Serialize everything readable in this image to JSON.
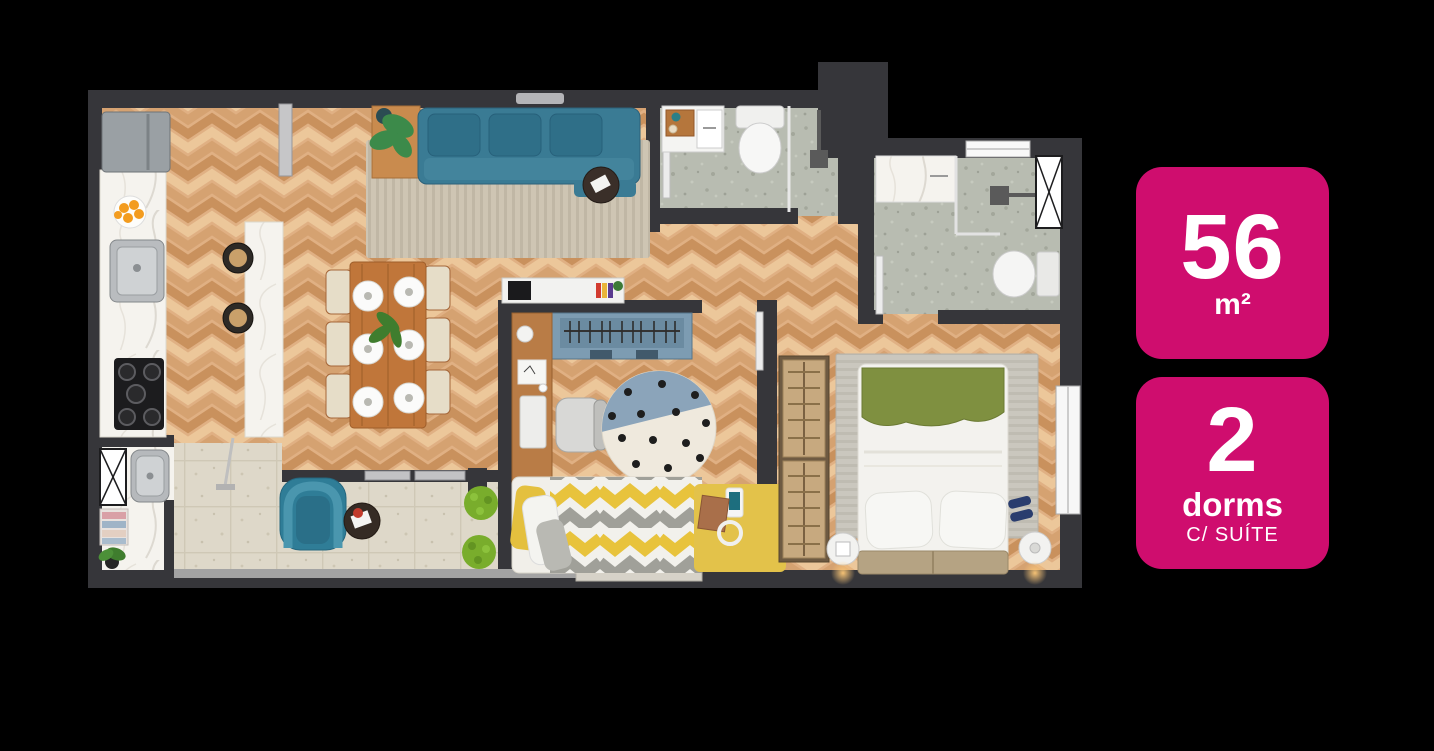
{
  "background_color": "#000000",
  "accent_color": "#cf0d6e",
  "badges": [
    {
      "value": "56",
      "unit": "m²"
    },
    {
      "value": "2",
      "label": "dorms",
      "sublabel": "C/ SUÍTE"
    }
  ],
  "floor_plan": {
    "type": "apartment-top-view-render",
    "rooms": [
      "kitchen",
      "living-dining",
      "hallway",
      "social-bathroom",
      "suite-bathroom",
      "kids-bedroom",
      "suite-bedroom",
      "service-area",
      "balcony"
    ],
    "colors": {
      "wall": "#36363a",
      "wood_floor": "#e0b083",
      "bathroom_tile": "#b8bcb1",
      "balcony_tile": "#ded8c9",
      "marble": "#f5f3ee",
      "sofa_teal": "#3a7b94",
      "kids_yellow": "#e3c24a",
      "suite_green": "#7f9040",
      "wardrobe_blue": "#7d9cb2",
      "wardrobe_tan": "#c7a97f"
    }
  }
}
